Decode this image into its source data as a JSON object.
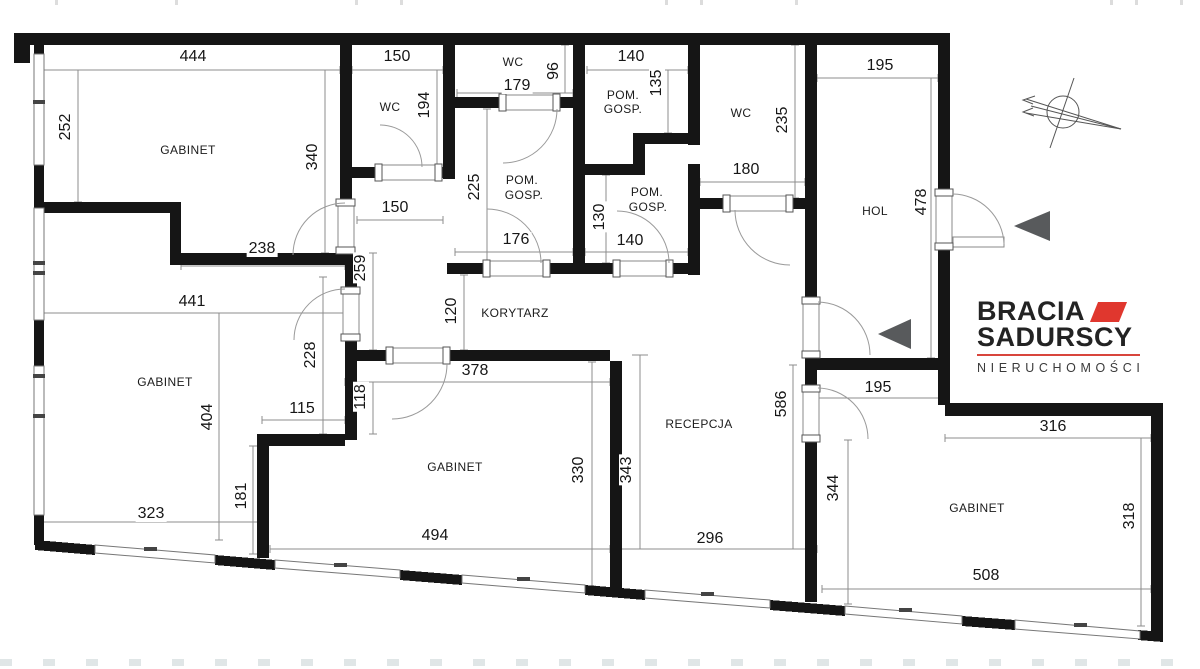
{
  "plan": {
    "rooms": {
      "gabinet": "GABINET",
      "wc": "WC",
      "pom": "POM.",
      "gosp": "GOSP.",
      "korytarz": "KORYTARZ",
      "recepcja": "RECEPCJA",
      "hol": "HOL"
    },
    "dimensions": {
      "d444": "444",
      "d252": "252",
      "d340": "340",
      "d238": "238",
      "d150a": "150",
      "d194": "194",
      "d150b": "150",
      "d259": "259",
      "d179": "179",
      "d96": "96",
      "d225": "225",
      "d176": "176",
      "d140a": "140",
      "d135": "135",
      "d130": "130",
      "d140b": "140",
      "d235": "235",
      "d180": "180",
      "d195a": "195",
      "d478": "478",
      "d441": "441",
      "d120": "120",
      "d228": "228",
      "d378": "378",
      "d118": "118",
      "d404": "404",
      "d115": "115",
      "d181": "181",
      "d323": "323",
      "d330": "330",
      "d343": "343",
      "d494": "494",
      "d296": "296",
      "d586": "586",
      "d195b": "195",
      "d344": "344",
      "d316": "316",
      "d318": "318",
      "d508": "508"
    }
  },
  "branding": {
    "logo_line1": "BRACIA",
    "logo_line2": "SADURSCY",
    "logo_line3": "NIERUCHOMOŚCI"
  },
  "colors": {
    "wall": "#151515",
    "dim_line": "#8c8c8c",
    "logo_red": "#e0372e",
    "arrow_gray": "#585a5c"
  },
  "icons": {
    "compass": "north-arrow-icon",
    "entry_arrows": "entry-arrow-icon"
  }
}
